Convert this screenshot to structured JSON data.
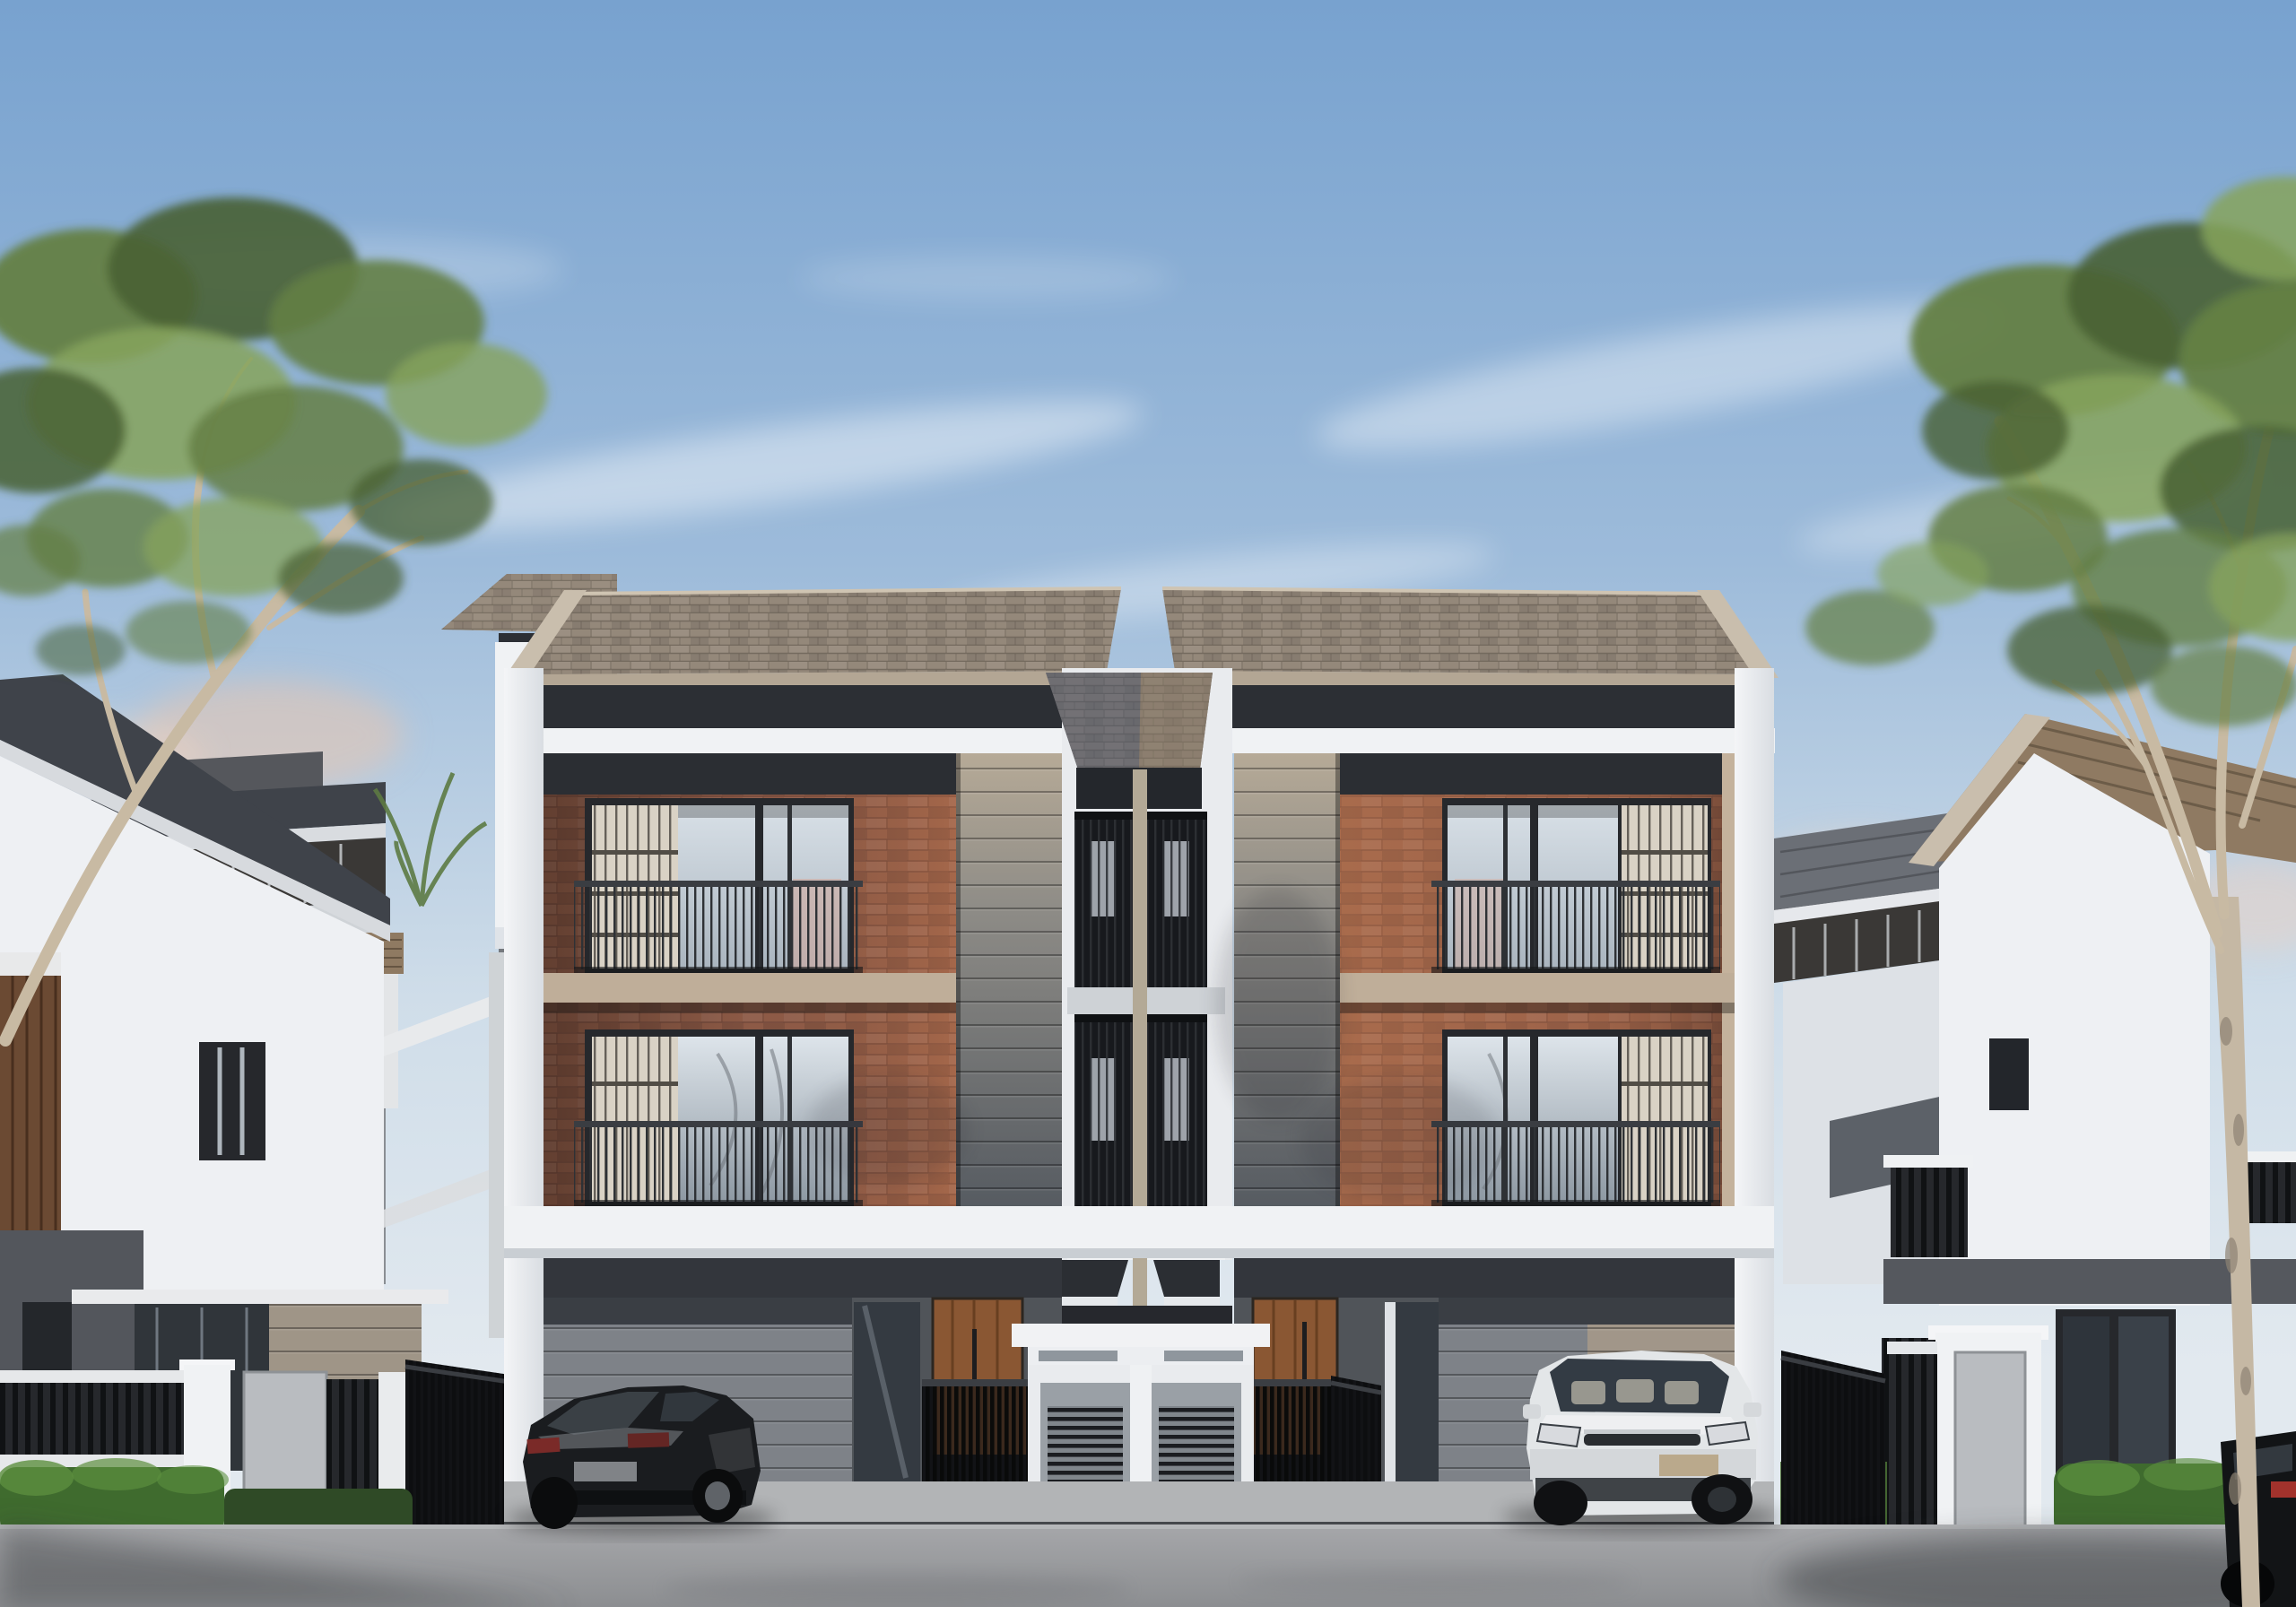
{
  "scene": {
    "type": "architectural-exterior-rendering",
    "subject": "modern three-story twin townhouse duplex with carports",
    "elements": {
      "main_building": "symmetric duplex: brick window bays, horizontal siding panels, white frames, shingle gable roofs, central stair tower with slatted balconies, ground-floor carports, wooden entry doors, black slat gates, central white utility kiosk with louvers and grass strip",
      "left_neighbor": "white gable house with dark roof, white fence wall with black railing, hedge, gate pillar",
      "right_neighbor": "white gable house with tan roof, gate pillar, hedge, plane tree in front",
      "background": "additional row houses with roof decks on both sides",
      "vehicles": [
        "black coupe parked in left carport",
        "white SUV parked in right carport",
        "dark car at bottom-right corner"
      ],
      "trees": [
        "leafy tree upper-left",
        "leafy tree upper-right with pale trunk"
      ]
    }
  },
  "palette": {
    "sky_top": "#78a2cf",
    "sky_mid": "#9dbbda",
    "sky_low": "#cfdde9",
    "horizon_glow": "#ecd2c4",
    "cloud_white": "#ffffff",
    "roof_shingle": "#958а7c",
    "roof_shingle_base": "#94887a",
    "roof_ridge": "#cfc4b2",
    "roof_gable_fascia": "#c9bead",
    "roof_eave_tan": "#b3a694",
    "roof_mid_shadow": "#565d6b",
    "roof_mid_warm": "#8a7a66",
    "soffit_dark": "#2c2f34",
    "trim_white": "#f0f2f4",
    "trim_white_dim": "#dfe3e8",
    "beam_shadow": "#c9ced3",
    "brick_base": "#935e49",
    "brick_mortar": "#6e463a",
    "slab_tan": "#bfae99",
    "siding_top_tan": "#b6aa97",
    "siding_mid": "#8d8b86",
    "siding_low": "#565b61",
    "window_frame": "#26282c",
    "glass_hi_top": "#d8e0e7",
    "glass_hi_bot": "#aab5bf",
    "glass_lo_top": "#dde4ea",
    "glass_lo_bot": "#8e99a3",
    "lattice_cream": "#d9d2c5",
    "lattice_bar": "#514d46",
    "railing_dark": "#2e3135",
    "warm_reflection": "#d2a89a",
    "carport_wall": "#7e8288",
    "carport_wall_sun": "#a79a89",
    "carport_dark_band": "#33363c",
    "carport_floor": "#b7b9bb",
    "wood_door": "#8a5733",
    "wood_plank_line": "#522f14",
    "gate_dark": "#121316",
    "gate_wood_glow": "#7a4c28",
    "utility_white": "#e9ebee",
    "utility_gray": "#9aa0a6",
    "louver_dark": "#1b1d21",
    "grass_green": "#58853b",
    "grass_light": "#76a24c",
    "curb_white": "#d6d9dc",
    "apron": "#b2b4b6",
    "apron_edge": "#45484c",
    "road_top": "#a6a7aa",
    "road_bot": "#8c8e91",
    "shadow_dark": "#35373b",
    "hedge_green": "#3f6b2e",
    "hedge_light": "#5c8f3f",
    "foliage_dark": "#48603395",
    "foliage_d": "#486033",
    "foliage_mid": "#647f45",
    "foliage_light": "#86a35c",
    "branch_pale": "#c8baa3",
    "trunk_pale": "#c5b8a4",
    "trunk_mottle": "#8e8374",
    "neighbor_white": "#eef0f3",
    "neighbor_roof_dark": "#3f434a",
    "neighbor_roof_tan": "#8f7a62",
    "bg_deck_dark": "#3a3836",
    "bg_wall_gray": "#8a8e93",
    "glow_amber": "#e8c4ae",
    "fence_dark": "#26282c",
    "fence_bar": "#101214",
    "pillar_panel_gray": "#b9bcc0",
    "car_black": "#1a1c1f",
    "car_black_glass": "#3c4248",
    "car_black_hl": "#8b9095",
    "taillight_red": "#a2322c",
    "car_white": "#e3e6e8",
    "car_white_glass": "#333b44",
    "car_white_grille": "#2a2d31",
    "plate_tan": "#baa98c"
  }
}
